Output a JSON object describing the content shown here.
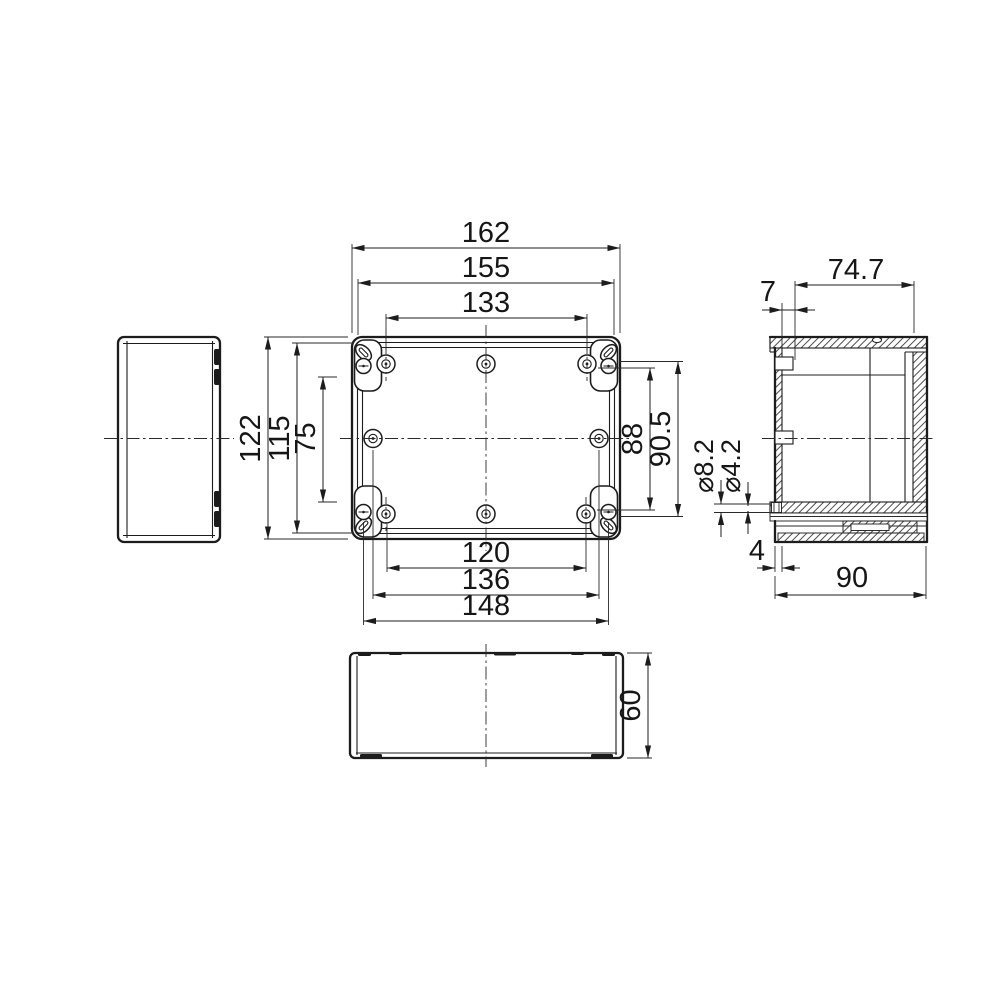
{
  "drawing": {
    "top_view_dims": {
      "total_width": "162",
      "lid_width": "155",
      "hole_span_top": "133",
      "total_height": "122",
      "lid_height": "115",
      "hole_span_left": "75",
      "hole_span_right": "88",
      "lug_span_right": "90.5",
      "hole_span_bottom": "120",
      "hole_span_mid": "136",
      "lug_span_bottom": "148"
    },
    "section_view_dims": {
      "depth_upper": "74.7",
      "lip_offset": "7",
      "flange_hole_outer": "⌀8.2",
      "flange_hole_inner": "⌀4.2",
      "flange_offset": "4",
      "depth_total": "90"
    },
    "front_view_dims": {
      "height": "60"
    }
  }
}
